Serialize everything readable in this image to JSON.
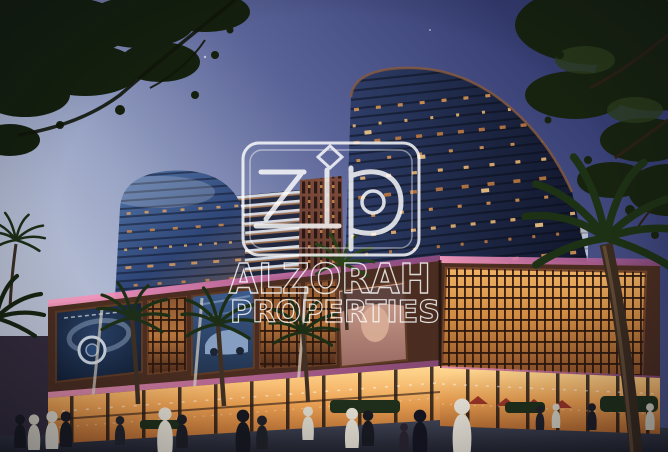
{
  "image": {
    "kind": "architectural-rendering-photo",
    "description": "Dusk view looking up at two curved glass residential towers above an illuminated retail podium with bronze lattice screens, LED billboards, palm trees and pedestrians",
    "time_of_day": "dusk"
  },
  "watermark": {
    "brand_monogram": "Zip",
    "company_line1": "ALZORAH",
    "company_line2": "PROPERTIES",
    "color": "#ffffff"
  },
  "scene": {
    "billboards": [
      "watch advertisement",
      "car advertisement",
      "portrait advertisement"
    ],
    "palette": {
      "sky_top": "#353d72",
      "sky_horizon": "#cdd3e1",
      "foliage": "#16210f",
      "tower_glass": "#1b2440",
      "warm_window_light": "#e8a053",
      "bronze_lattice": "#8a5530",
      "led_trim": "#ff9fc4",
      "storefront_glow": "#f0a352",
      "pavement": "#23252f"
    }
  }
}
